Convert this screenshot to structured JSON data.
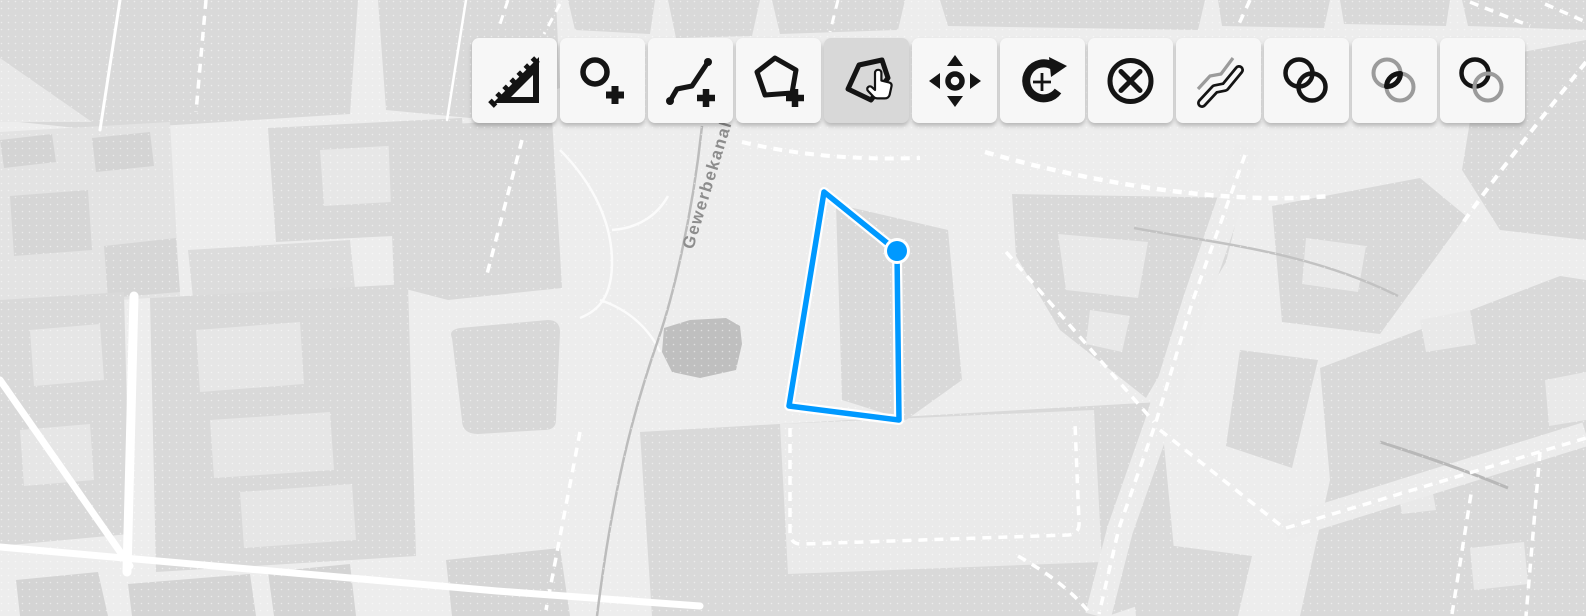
{
  "app": {
    "type": "map-editor"
  },
  "toolbar": {
    "buttons": [
      {
        "icon": "measure-icon",
        "active": false
      },
      {
        "icon": "draw-point-icon",
        "active": false
      },
      {
        "icon": "draw-line-icon",
        "active": false
      },
      {
        "icon": "draw-polygon-icon",
        "active": false
      },
      {
        "icon": "modify-polygon-icon",
        "active": true
      },
      {
        "icon": "move-icon",
        "active": false
      },
      {
        "icon": "rotate-icon",
        "active": false
      },
      {
        "icon": "delete-icon",
        "active": false
      },
      {
        "icon": "offset-icon",
        "active": false
      },
      {
        "icon": "union-icon",
        "active": false
      },
      {
        "icon": "intersection-icon",
        "active": false
      },
      {
        "icon": "difference-icon",
        "active": false
      }
    ]
  },
  "map": {
    "street_label": "Gewerbekanal",
    "colors": {
      "background": "#ededed",
      "block": "#d9d9d9",
      "courtyard": "#e9e9e9",
      "road": "#ffffff",
      "canal": "#bcbcbc",
      "label": "#8d8d8d",
      "accent_blue": "#0099ff",
      "active_button": "#d8d8d8"
    },
    "feature": {
      "type": "polygon",
      "stroke": "#0099ff",
      "casing": "#ffffff",
      "vertices": [
        [
          824,
          192
        ],
        [
          897,
          251
        ],
        [
          899,
          420
        ],
        [
          789,
          406
        ]
      ],
      "active_vertex": [
        897,
        251
      ]
    }
  }
}
